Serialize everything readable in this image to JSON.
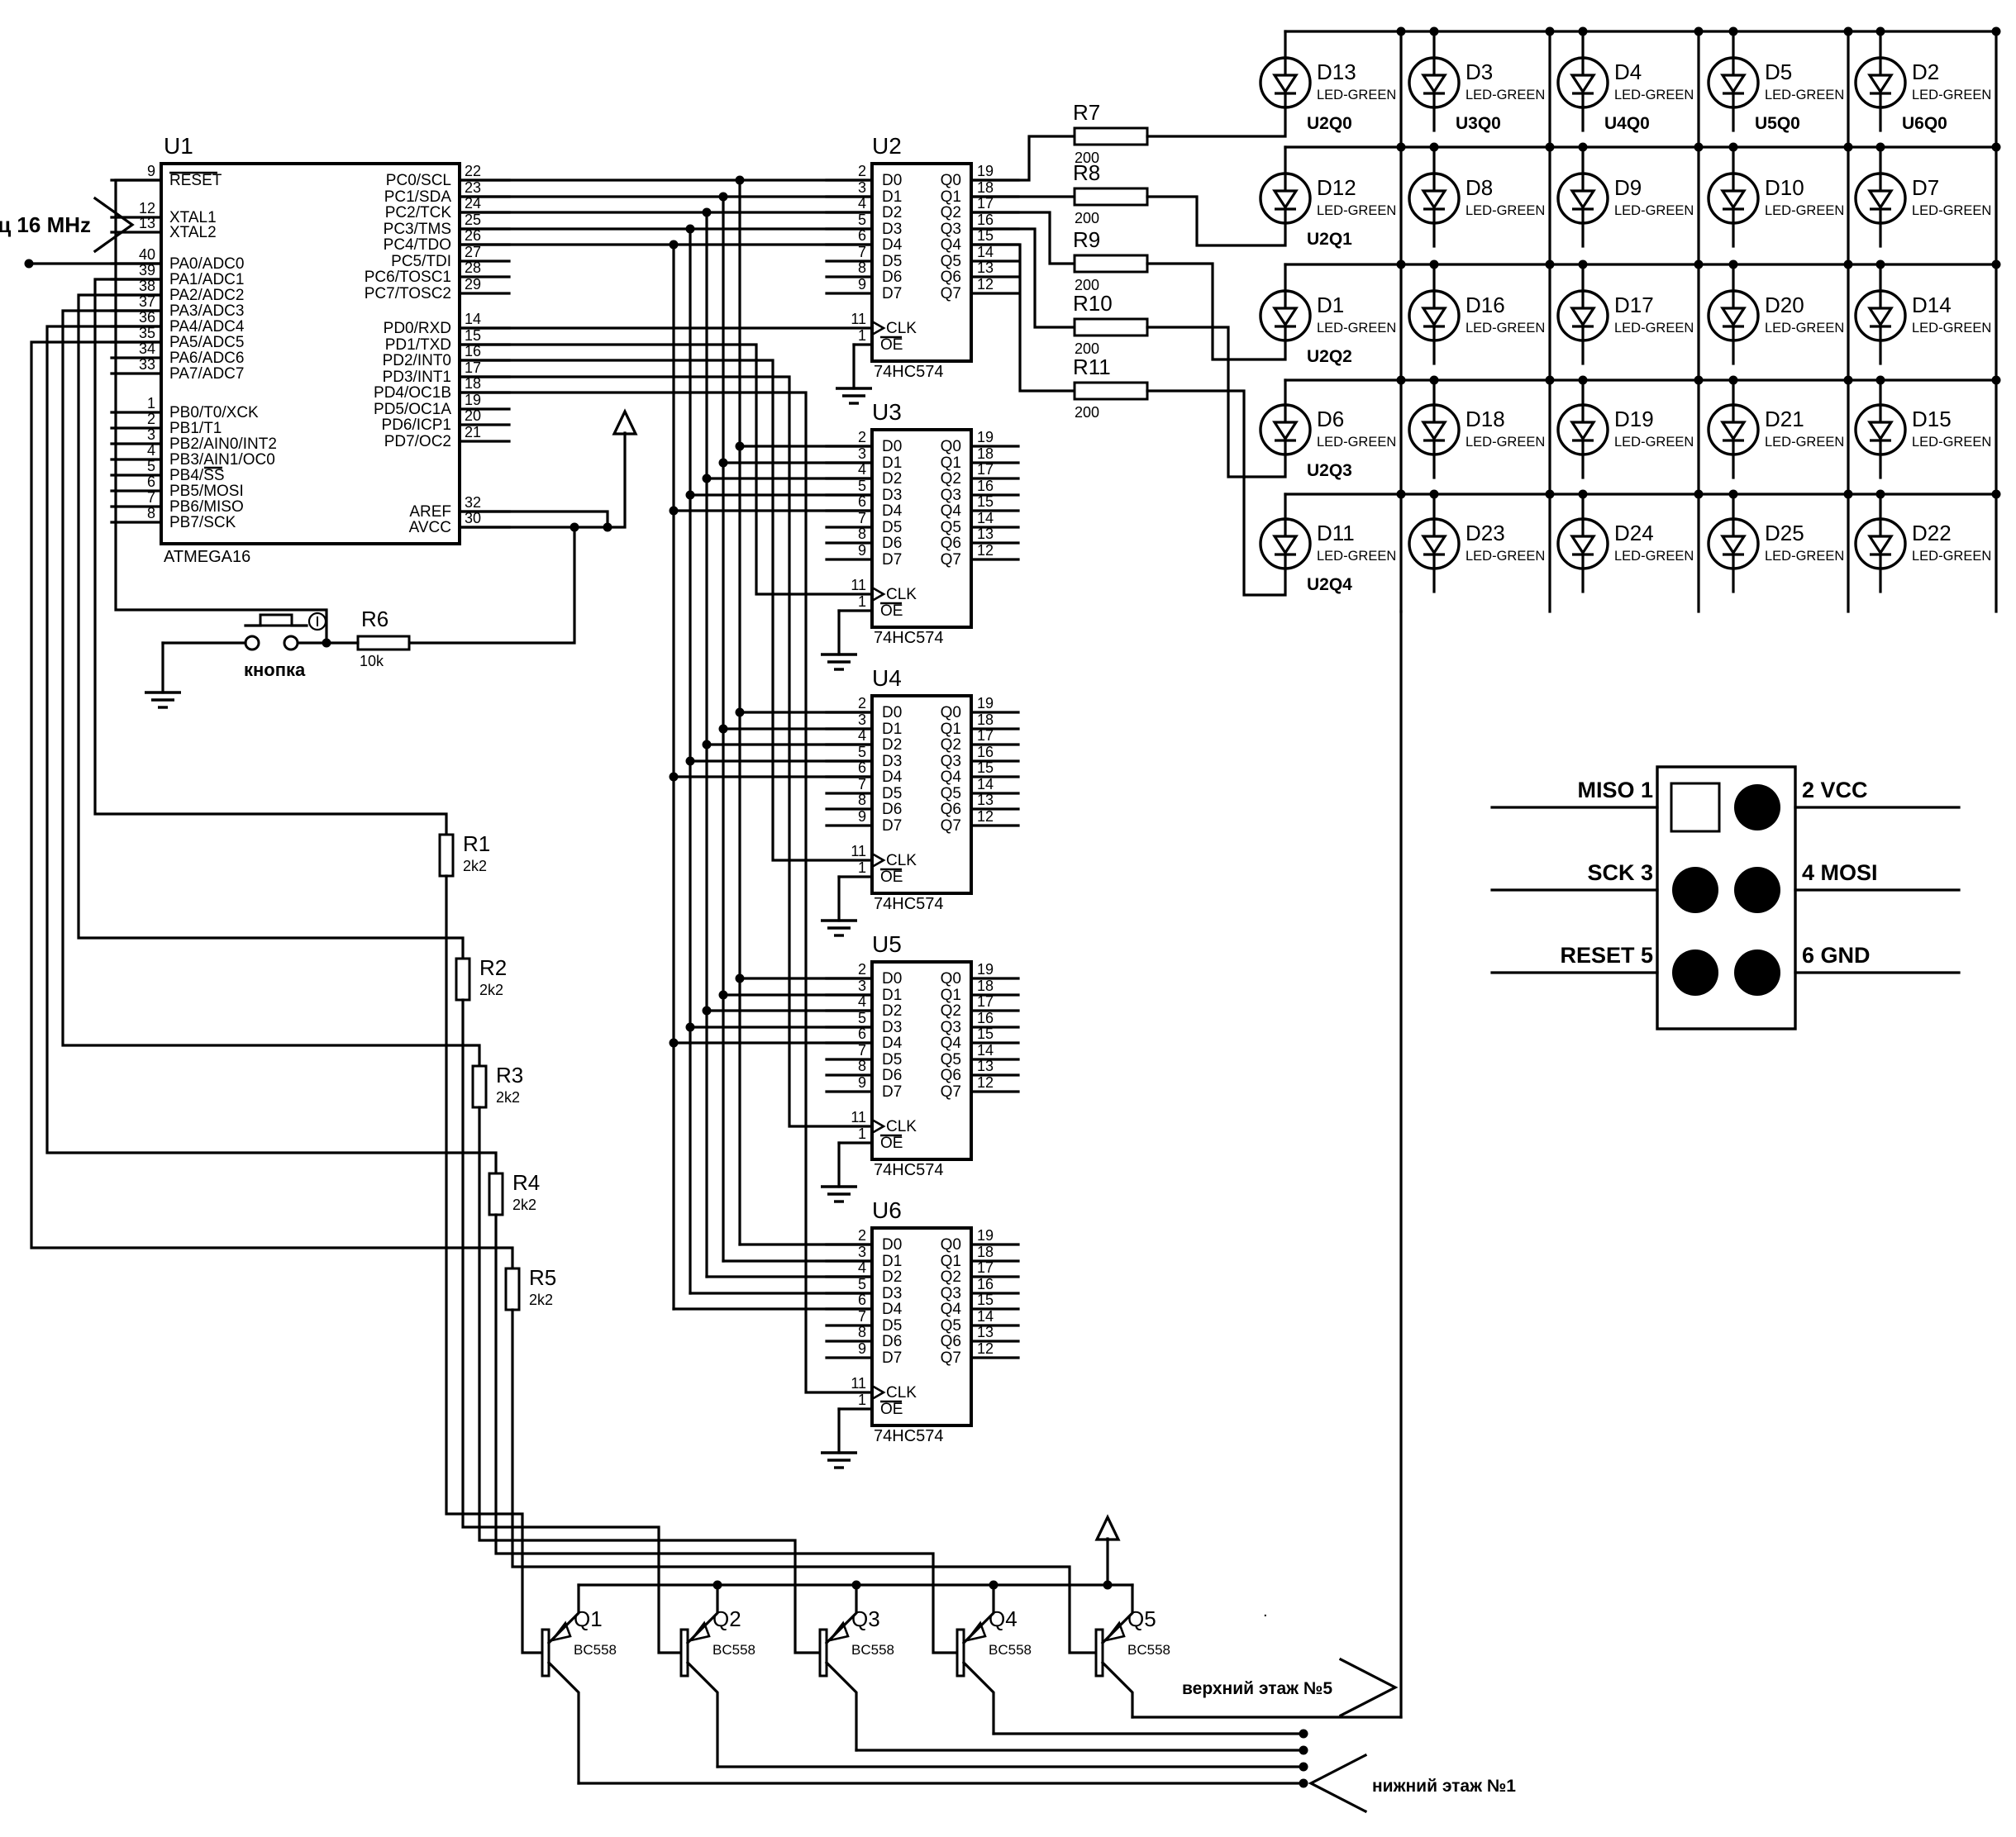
{
  "colors": {
    "ink": "#000000",
    "paper": "#ffffff"
  },
  "mcu": {
    "ref": "U1",
    "part": "ATMEGA16",
    "left_pins": [
      {
        "n": "9",
        "label": "RESET",
        "bar": "full"
      },
      {
        "n": "12",
        "label": "XTAL1"
      },
      {
        "n": "13",
        "label": "XTAL2"
      },
      {
        "n": "40",
        "label": "PA0/ADC0"
      },
      {
        "n": "39",
        "label": "PA1/ADC1"
      },
      {
        "n": "38",
        "label": "PA2/ADC2"
      },
      {
        "n": "37",
        "label": "PA3/ADC3"
      },
      {
        "n": "36",
        "label": "PA4/ADC4"
      },
      {
        "n": "35",
        "label": "PA5/ADC5"
      },
      {
        "n": "34",
        "label": "PA6/ADC6"
      },
      {
        "n": "33",
        "label": "PA7/ADC7"
      },
      {
        "n": "1",
        "label": "PB0/T0/XCK"
      },
      {
        "n": "2",
        "label": "PB1/T1"
      },
      {
        "n": "3",
        "label": "PB2/AIN0/INT2"
      },
      {
        "n": "4",
        "label": "PB3/AIN1/OC0"
      },
      {
        "n": "5",
        "label": "PB4/SS",
        "bar": "suffix2"
      },
      {
        "n": "6",
        "label": "PB5/MOSI"
      },
      {
        "n": "7",
        "label": "PB6/MISO"
      },
      {
        "n": "8",
        "label": "PB7/SCK"
      }
    ],
    "right_pins": [
      {
        "n": "22",
        "label": "PC0/SCL"
      },
      {
        "n": "23",
        "label": "PC1/SDA"
      },
      {
        "n": "24",
        "label": "PC2/TCK"
      },
      {
        "n": "25",
        "label": "PC3/TMS"
      },
      {
        "n": "26",
        "label": "PC4/TDO"
      },
      {
        "n": "27",
        "label": "PC5/TDI"
      },
      {
        "n": "28",
        "label": "PC6/TOSC1"
      },
      {
        "n": "29",
        "label": "PC7/TOSC2"
      },
      {
        "n": "14",
        "label": "PD0/RXD"
      },
      {
        "n": "15",
        "label": "PD1/TXD"
      },
      {
        "n": "16",
        "label": "PD2/INT0"
      },
      {
        "n": "17",
        "label": "PD3/INT1"
      },
      {
        "n": "18",
        "label": "PD4/OC1B"
      },
      {
        "n": "19",
        "label": "PD5/OC1A"
      },
      {
        "n": "20",
        "label": "PD6/ICP1"
      },
      {
        "n": "21",
        "label": "PD7/OC2"
      },
      {
        "n": "32",
        "label": "AREF"
      },
      {
        "n": "30",
        "label": "AVCC"
      }
    ]
  },
  "latch_pins": {
    "d_nums": [
      "2",
      "3",
      "4",
      "5",
      "6",
      "7",
      "8",
      "9"
    ],
    "d_labels": [
      "D0",
      "D1",
      "D2",
      "D3",
      "D4",
      "D5",
      "D6",
      "D7"
    ],
    "q_nums": [
      "19",
      "18",
      "17",
      "16",
      "15",
      "14",
      "13",
      "12"
    ],
    "q_labels": [
      "Q0",
      "Q1",
      "Q2",
      "Q3",
      "Q4",
      "Q5",
      "Q6",
      "Q7"
    ],
    "clk_num": "11",
    "clk_label": "CLK",
    "oe_num": "1",
    "oe_label": "OE"
  },
  "latches": [
    {
      "ref": "U2",
      "part": "74HC574"
    },
    {
      "ref": "U3",
      "part": "74HC574"
    },
    {
      "ref": "U4",
      "part": "74HC574"
    },
    {
      "ref": "U5",
      "part": "74HC574"
    },
    {
      "ref": "U6",
      "part": "74HC574"
    }
  ],
  "led_matrix": {
    "type_label": "LED-GREEN",
    "rows": [
      [
        {
          "name": "D13",
          "net": "U2Q0"
        },
        {
          "name": "D3",
          "net": "U3Q0"
        },
        {
          "name": "D4",
          "net": "U4Q0"
        },
        {
          "name": "D5",
          "net": "U5Q0"
        },
        {
          "name": "D2",
          "net": "U6Q0"
        }
      ],
      [
        {
          "name": "D12",
          "net": "U2Q1"
        },
        {
          "name": "D8",
          "net": ""
        },
        {
          "name": "D9",
          "net": ""
        },
        {
          "name": "D10",
          "net": ""
        },
        {
          "name": "D7",
          "net": ""
        }
      ],
      [
        {
          "name": "D1",
          "net": "U2Q2"
        },
        {
          "name": "D16",
          "net": ""
        },
        {
          "name": "D17",
          "net": ""
        },
        {
          "name": "D20",
          "net": ""
        },
        {
          "name": "D14",
          "net": ""
        }
      ],
      [
        {
          "name": "D6",
          "net": "U2Q3"
        },
        {
          "name": "D18",
          "net": ""
        },
        {
          "name": "D19",
          "net": ""
        },
        {
          "name": "D21",
          "net": ""
        },
        {
          "name": "D15",
          "net": ""
        }
      ],
      [
        {
          "name": "D11",
          "net": "U2Q4"
        },
        {
          "name": "D23",
          "net": ""
        },
        {
          "name": "D24",
          "net": ""
        },
        {
          "name": "D25",
          "net": ""
        },
        {
          "name": "D22",
          "net": ""
        }
      ]
    ]
  },
  "row_resistors": [
    {
      "ref": "R7",
      "value": "200"
    },
    {
      "ref": "R8",
      "value": "200"
    },
    {
      "ref": "R9",
      "value": "200"
    },
    {
      "ref": "R10",
      "value": "200"
    },
    {
      "ref": "R11",
      "value": "200"
    }
  ],
  "base_resistors": [
    {
      "ref": "R1",
      "value": "2k2"
    },
    {
      "ref": "R2",
      "value": "2k2"
    },
    {
      "ref": "R3",
      "value": "2k2"
    },
    {
      "ref": "R4",
      "value": "2k2"
    },
    {
      "ref": "R5",
      "value": "2k2"
    }
  ],
  "pullup_resistor": {
    "ref": "R6",
    "value": "10k"
  },
  "transistors": [
    {
      "ref": "Q1",
      "part": "BC558"
    },
    {
      "ref": "Q2",
      "part": "BC558"
    },
    {
      "ref": "Q3",
      "part": "BC558"
    },
    {
      "ref": "Q4",
      "part": "BC558"
    },
    {
      "ref": "Q5",
      "part": "BC558"
    }
  ],
  "isp": {
    "rows": [
      {
        "left": "MISO 1",
        "right": "2 VCC"
      },
      {
        "left": "SCK 3",
        "right": "4 MOSI"
      },
      {
        "left": "RESET 5",
        "right": "6 GND"
      }
    ]
  },
  "labels": {
    "crystal": "кварц 16 MHz",
    "button": "кнопка",
    "upper_floor": "верхний этаж №5",
    "lower_floor": "нижний этаж №1",
    "stray": "."
  }
}
